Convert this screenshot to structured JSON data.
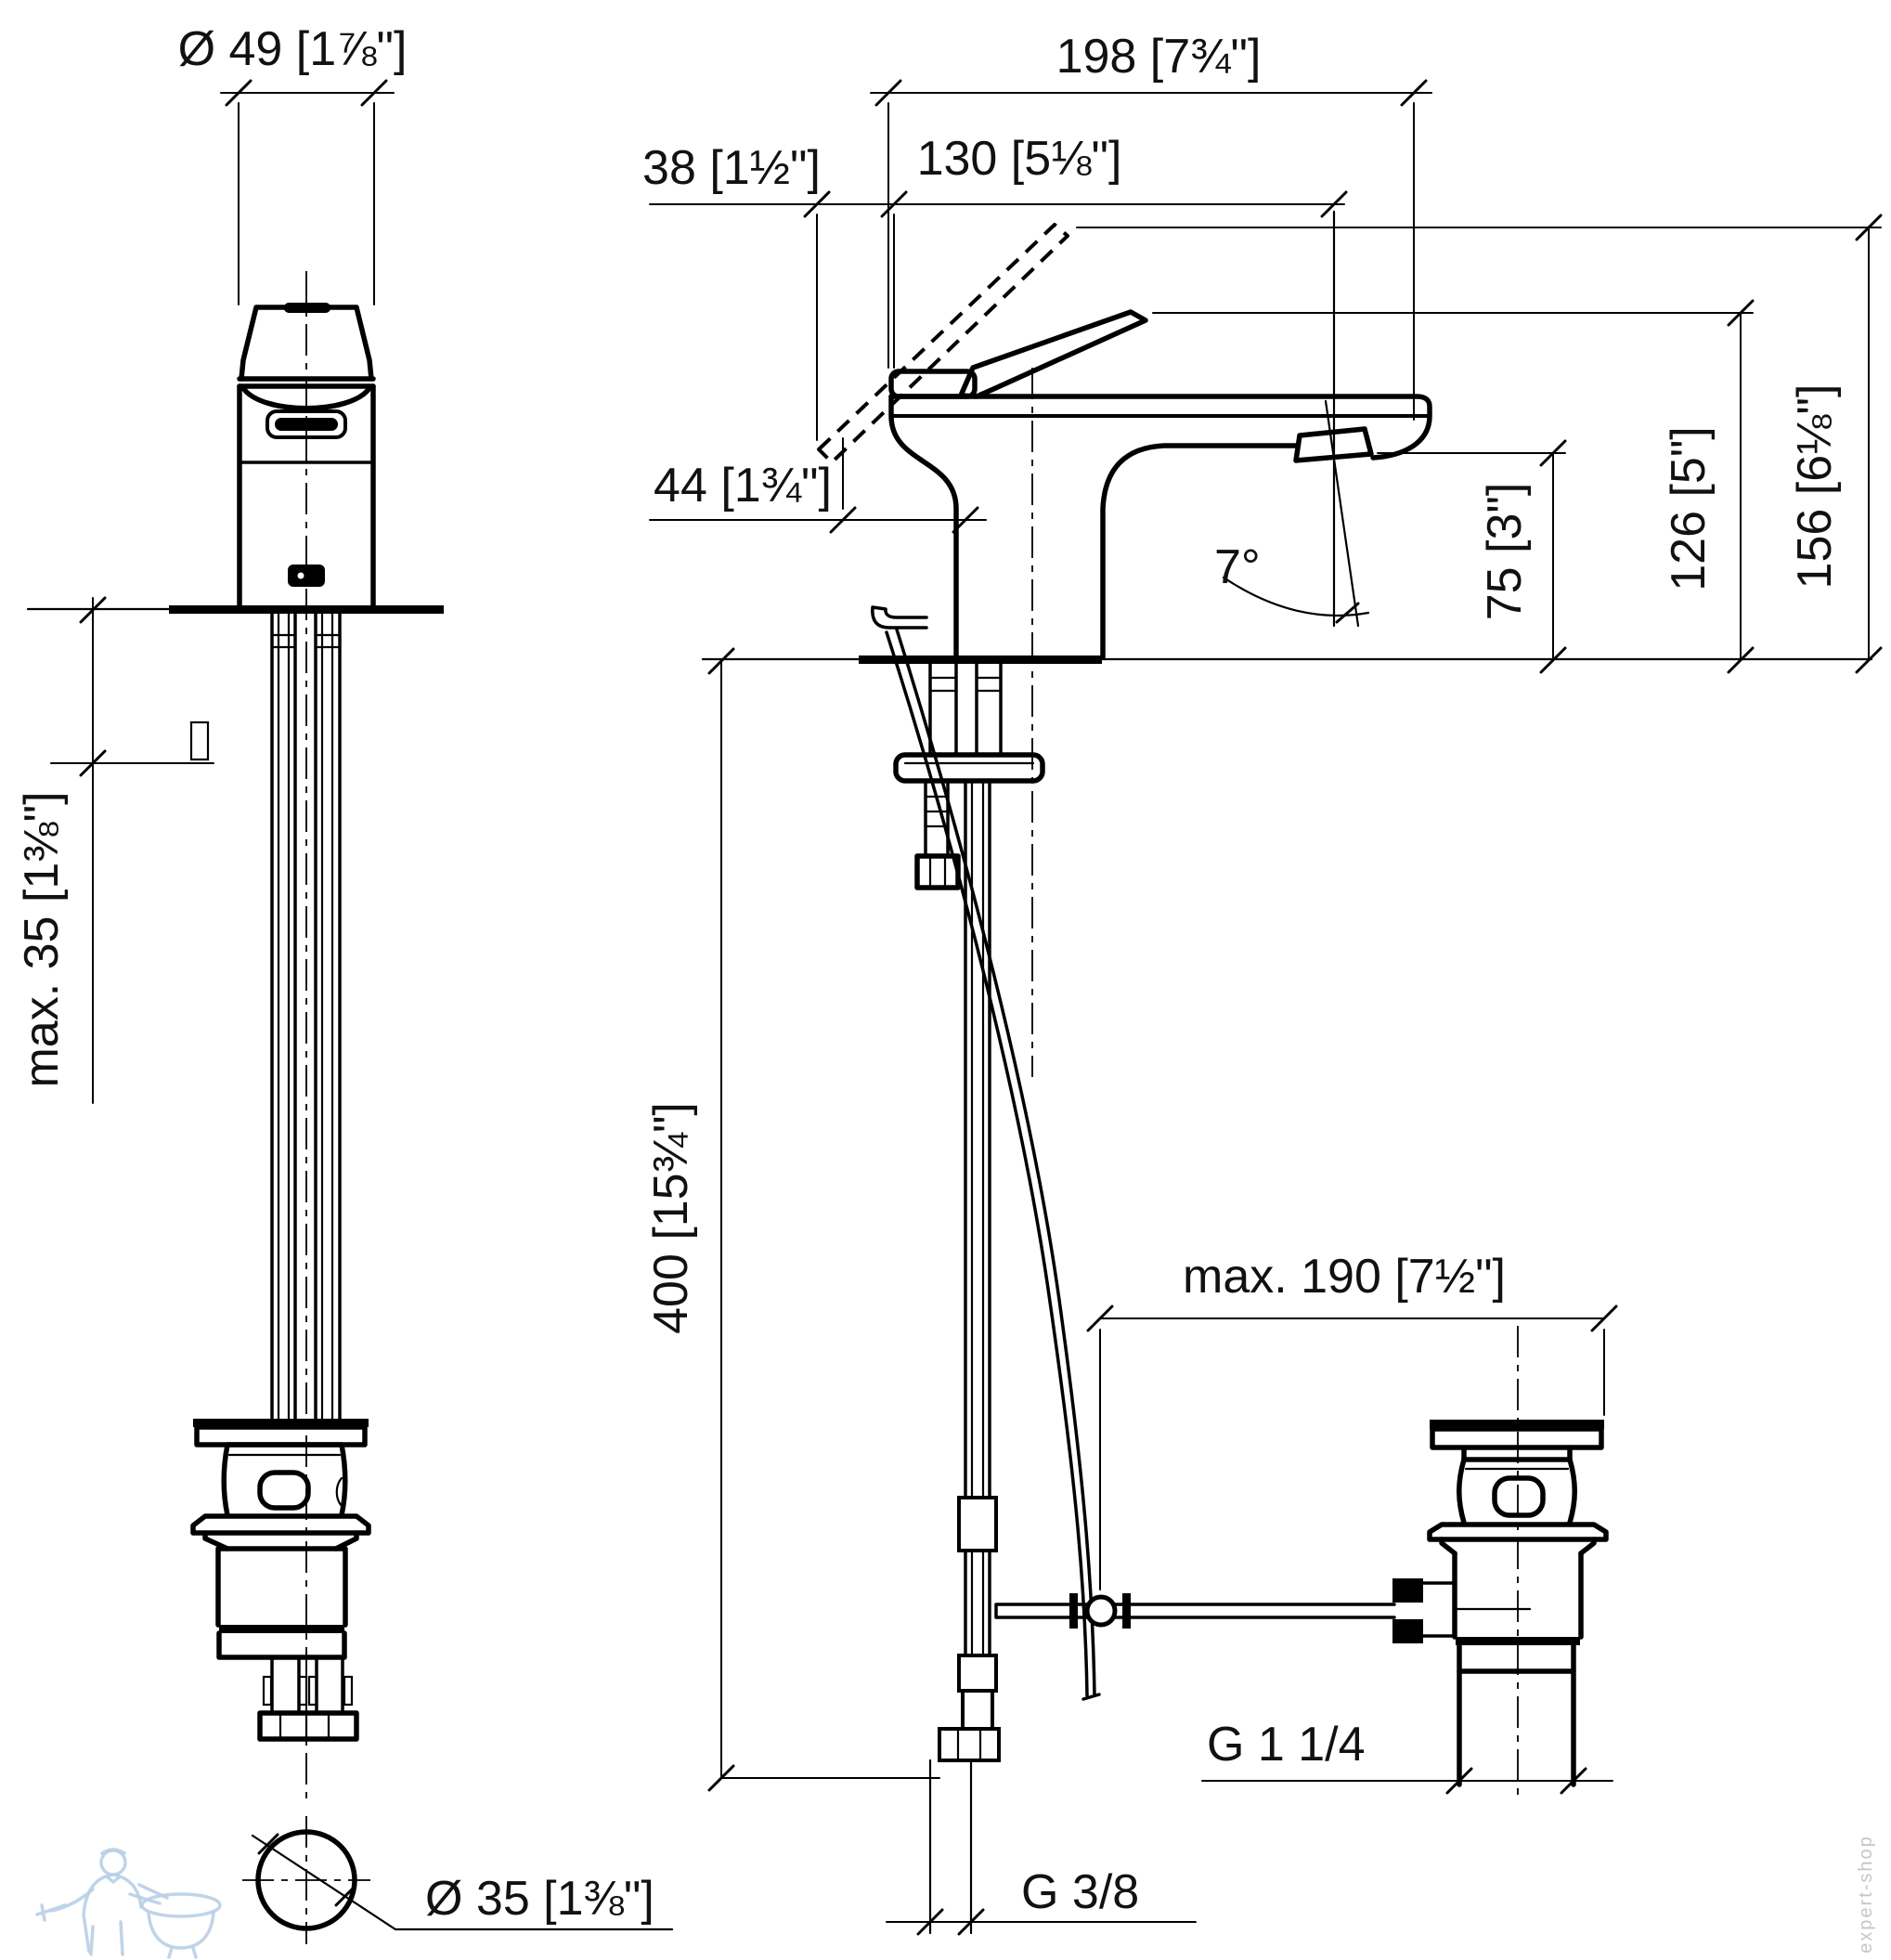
{
  "labels": {
    "dia49": "Ø 49 [1⅞\"]",
    "proj198": "198 [7¾\"]",
    "off38": "38 [1½\"]",
    "proj130": "130 [5⅛\"]",
    "depth44": "44 [1¾\"]",
    "angle7": "7°",
    "h75": "75 [3\"]",
    "h126": "126 [5\"]",
    "h156": "156 [6⅛\"]",
    "max35": "max. 35 [1⅜\"]",
    "hose400": "400 [15¾\"]",
    "rod190": "max. 190 [7½\"]",
    "g114": "G 1 1/4",
    "g38": "G 3/8",
    "dia35": "Ø 35 [1⅜\"]",
    "shop_watermark": "expert-shop"
  }
}
